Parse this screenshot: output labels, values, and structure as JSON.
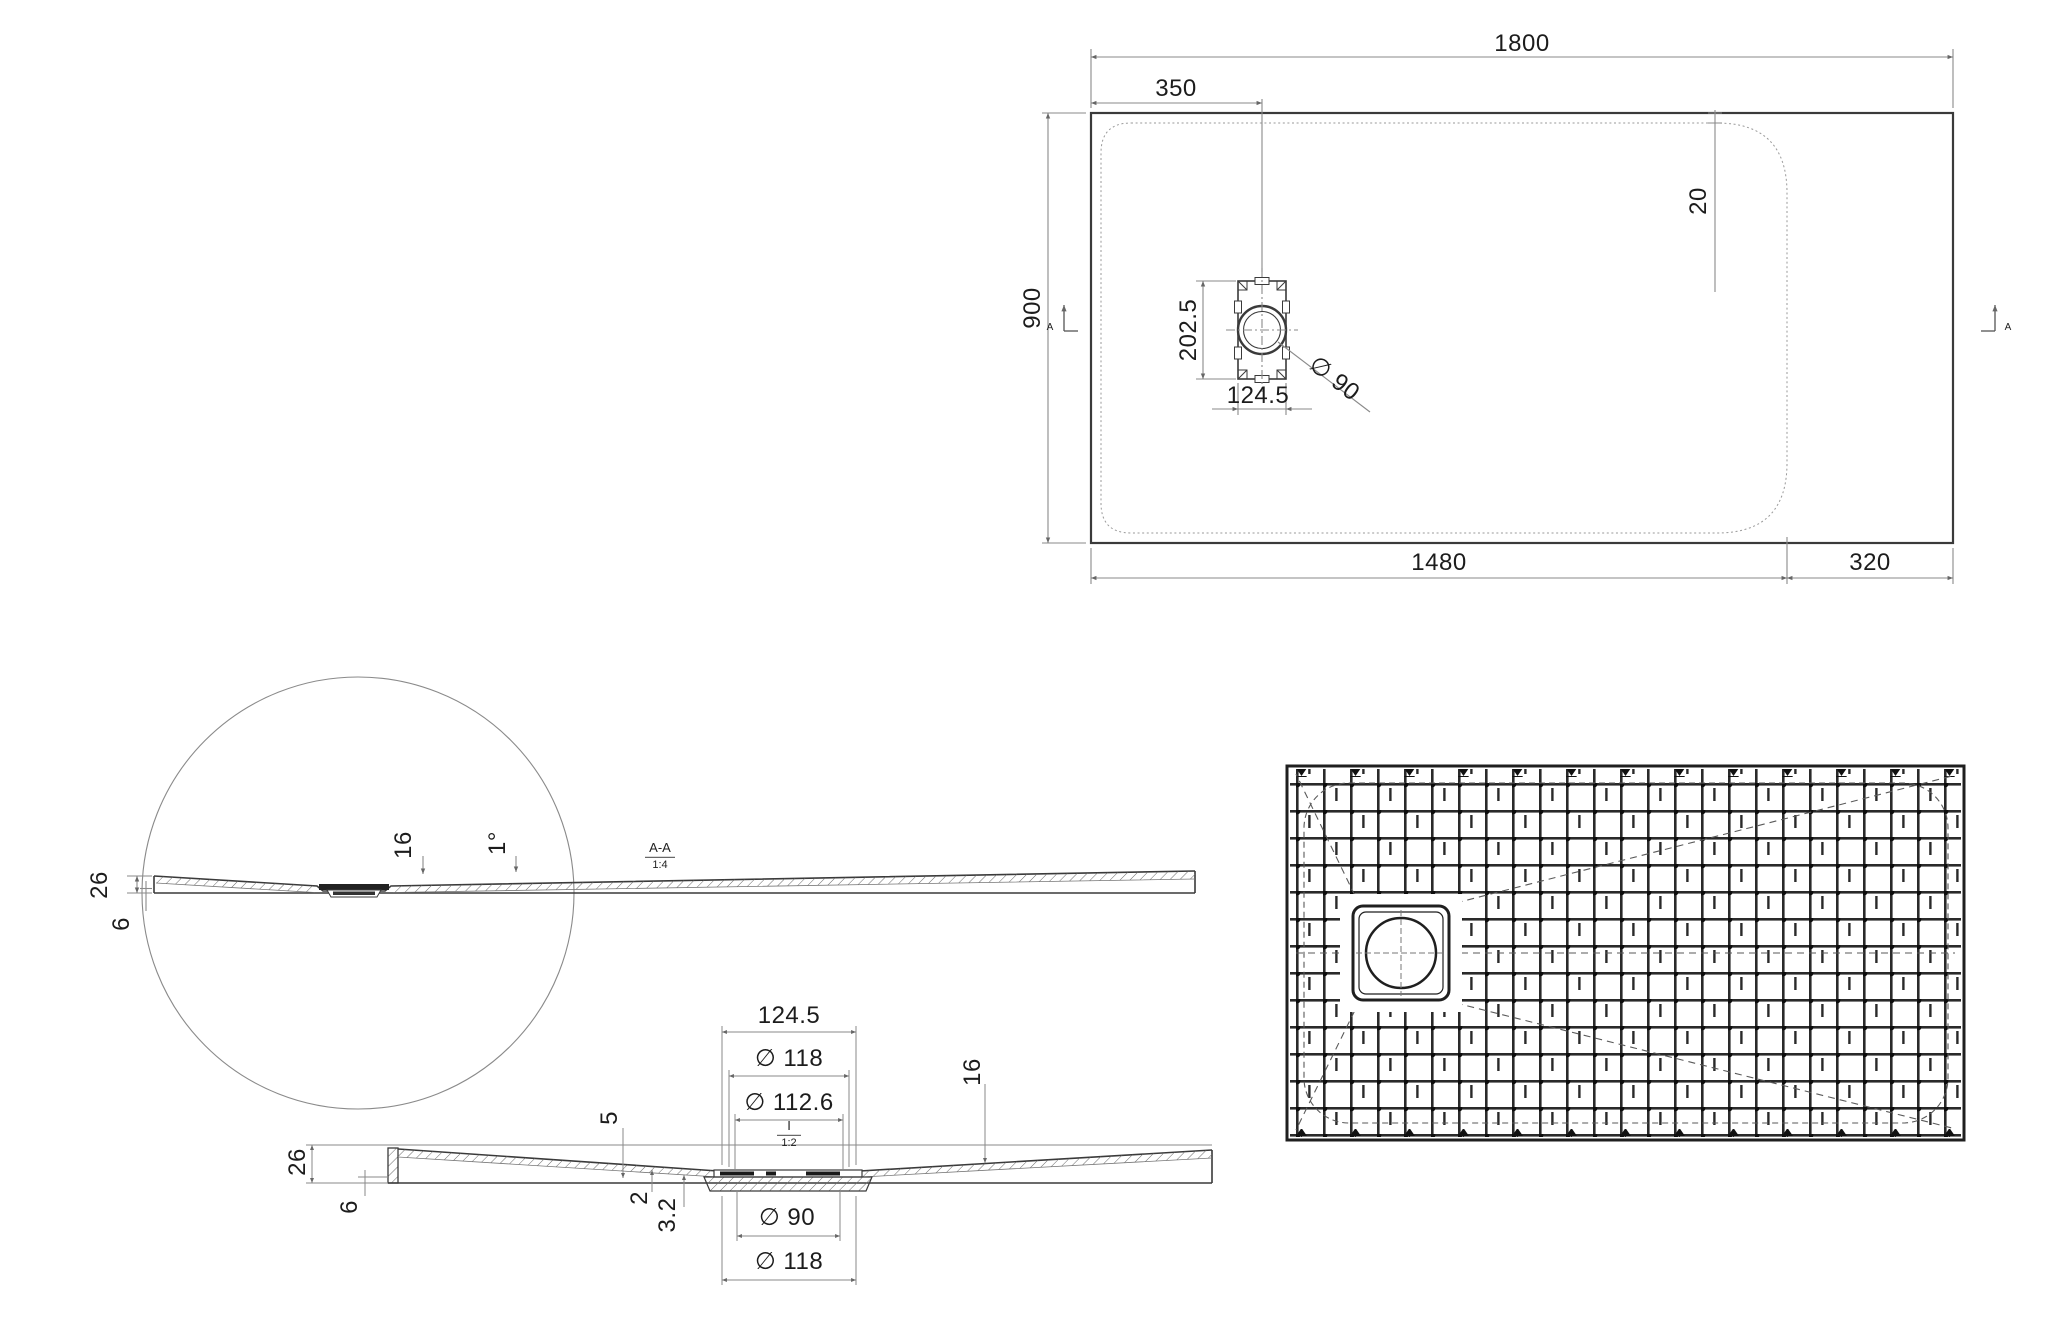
{
  "colors": {
    "outline": "#3a3a3a",
    "dimension": "#8a8a8a",
    "text": "#1c1c1c"
  },
  "plan_view": {
    "dim_total_width": "1800",
    "dim_drain_offset": "350",
    "dim_total_height": "900",
    "dim_corner_radius": "20",
    "dim_drain_height": "202.5",
    "dim_drain_width": "124.5",
    "dim_drain_diameter": "∅ 90",
    "dim_bottom_left": "1480",
    "dim_bottom_right": "320",
    "section_marker": "A"
  },
  "section_view": {
    "name": "A-A",
    "scale": "1:4",
    "dim_thickness": "16",
    "dim_slope": "1°",
    "dim_edge_height": "26",
    "dim_rim_height": "6"
  },
  "detail_view": {
    "name": "I",
    "scale": "1:2",
    "dim_flange_width": "124.5",
    "dim_outer_diameter": "∅ 118",
    "dim_inner_diameter": "∅ 112.6",
    "dim_thickness": "16",
    "dim_recess": "5",
    "dim_step": "2",
    "dim_step2": "3.2",
    "dim_drain_diameter": "∅ 90",
    "dim_bottom_diameter": "∅ 118",
    "dim_edge_height": "26",
    "dim_rim_height": "6"
  }
}
